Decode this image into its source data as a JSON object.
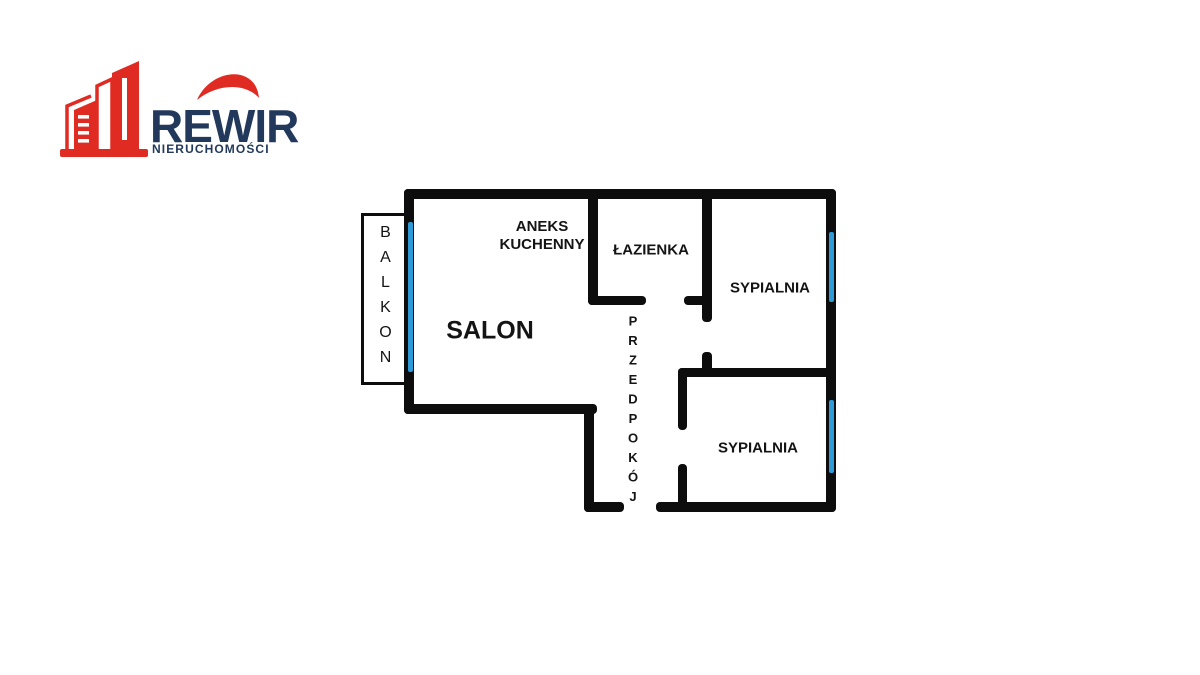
{
  "logo": {
    "brand": "REWIR",
    "subtitle": "NIERUCHOMOŚCI",
    "icons": [
      "buildings-icon",
      "swoosh-icon"
    ],
    "colors": {
      "red": "#E02B22",
      "navy": "#22395C"
    }
  },
  "floorplan": {
    "rooms": {
      "balkon": {
        "label": "BALKON"
      },
      "salon": {
        "label": "SALON"
      },
      "aneks": {
        "line1": "ANEKS",
        "line2": "KUCHENNY"
      },
      "lazienka": {
        "label": "ŁAZIENKA"
      },
      "sypialnia_top": {
        "label": "SYPIALNIA"
      },
      "sypialnia_bottom": {
        "label": "SYPIALNIA"
      },
      "przedpokoj": {
        "label": "PRZEDPOKÓJ"
      }
    },
    "colors": {
      "wall": "#0d0d0d",
      "window": "#2E9BD8"
    }
  }
}
